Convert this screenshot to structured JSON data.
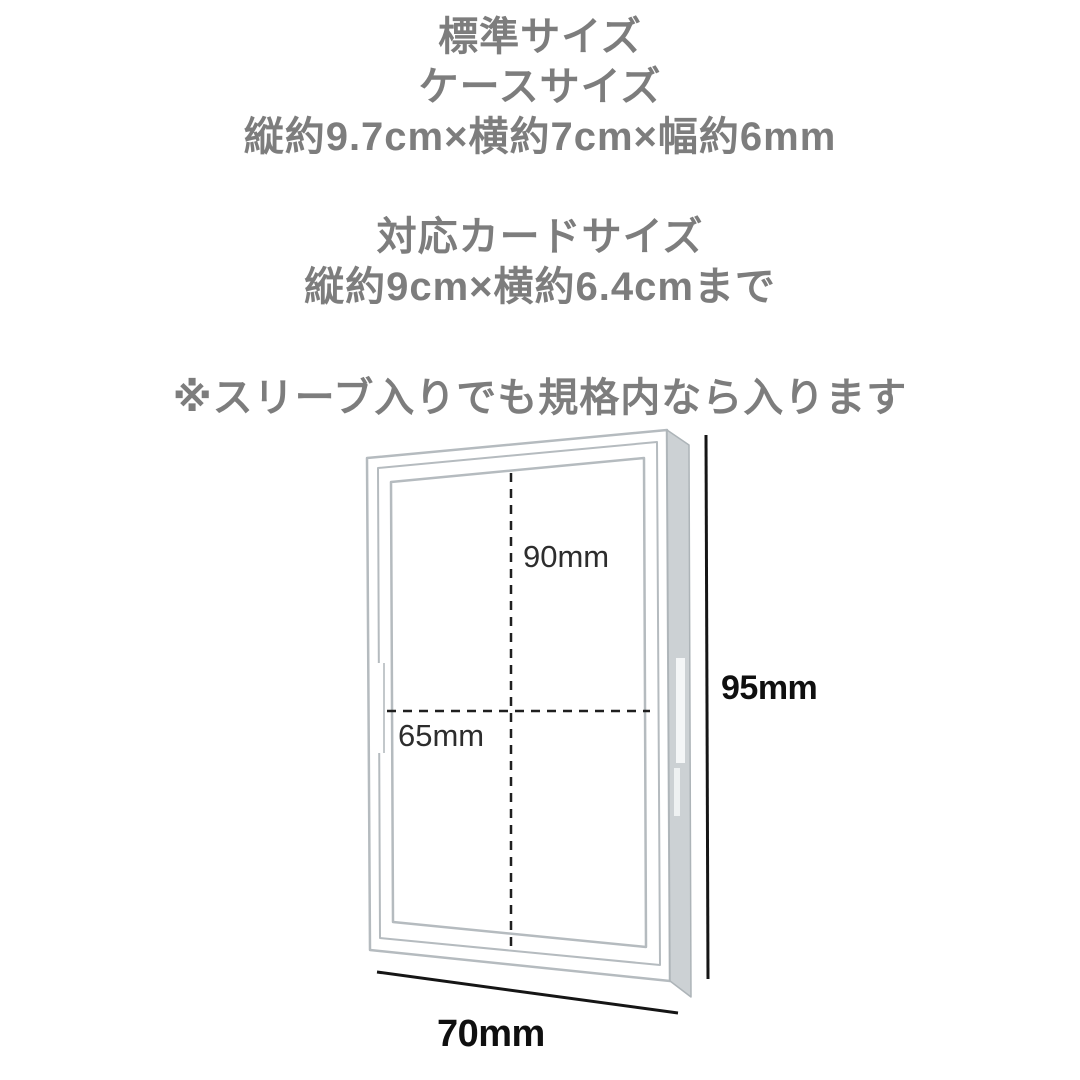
{
  "header": {
    "standard_size_title": "標準サイズ",
    "case_size_heading": "ケースサイズ",
    "case_size_dimensions": "縦約9.7cm×横約7cm×幅約6mm",
    "card_size_heading": "対応カードサイズ",
    "card_size_dimensions": "縦約9cm×横約6.4cmまで",
    "sleeve_note": "※スリーブ入りでも規格内なら入ります",
    "text_color": "#7d7d7d"
  },
  "diagram": {
    "labels": {
      "inner_height": "90mm",
      "inner_width": "65mm",
      "outer_height": "95mm",
      "outer_width": "70mm"
    },
    "colors": {
      "case_outline": "#b5bbbf",
      "case_depth_fill": "#ccd1d4",
      "dashed_line": "#1f1f1f",
      "dimension_line": "#151515",
      "inner_label_text": "#2d2d2d",
      "outer_label_text": "#0f0f0f",
      "background": "#ffffff"
    }
  }
}
